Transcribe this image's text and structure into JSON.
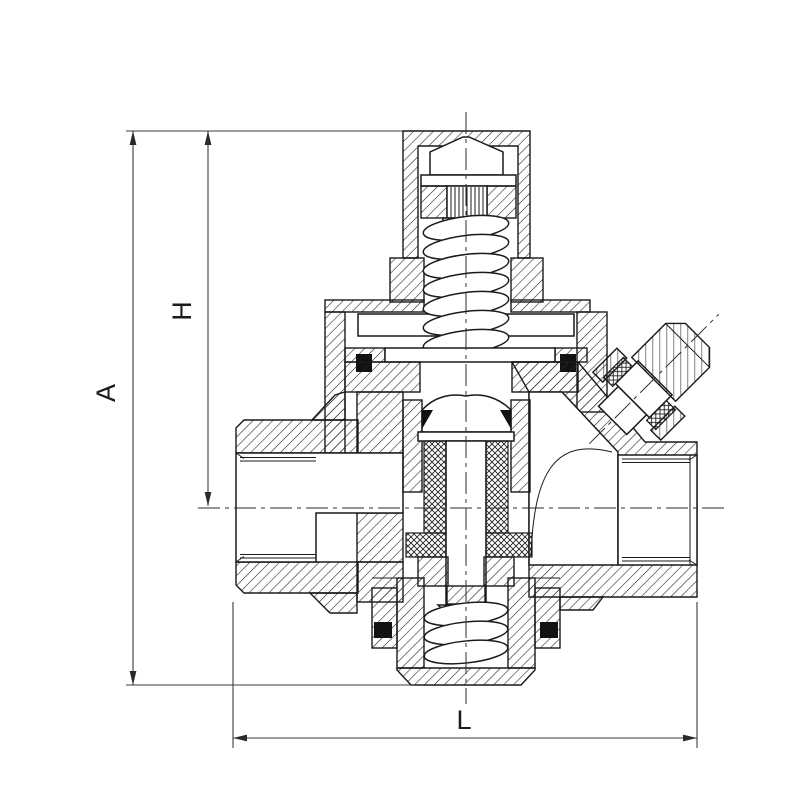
{
  "page": {
    "background_color": "#ffffff",
    "line_color": "#1a1a1a"
  },
  "drawing": {
    "kind": "valve-cross-section",
    "dimensions": {
      "overall_height_label": "A",
      "upper_height_label": "H",
      "length_label": "L"
    }
  }
}
